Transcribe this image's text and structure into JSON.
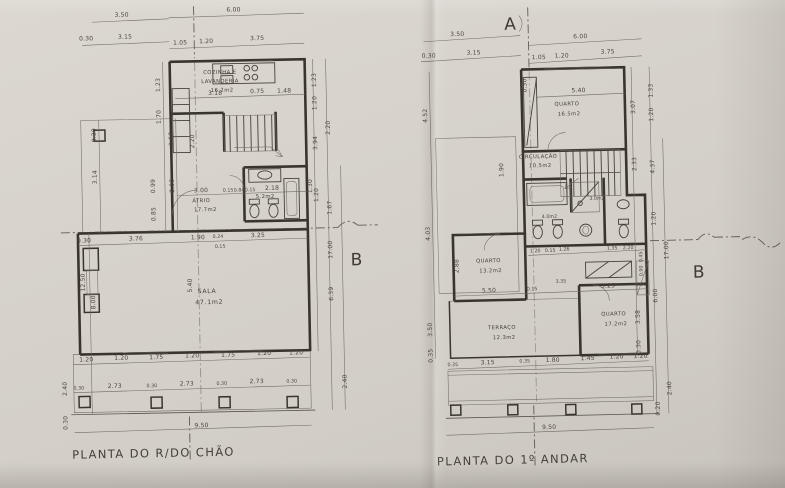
{
  "colors": {
    "paper": "#d6d2cb",
    "ink": "#4c463d",
    "wall": "#39352e"
  },
  "markers": {
    "a": "A",
    "b_left": "B",
    "b_right": "B"
  },
  "ground": {
    "caption": "PLANTA DO R/DO CHÃO",
    "rooms": {
      "kitchen_l1": "COZINHA E",
      "kitchen_l2": "LAVANDERIA",
      "kitchen_area": "16.2m2",
      "atrio": "ÁTRIO",
      "atrio_area": "17.7m2",
      "bath_area": "5.2m2",
      "sala": "SALA",
      "sala_area": "47.1m2"
    },
    "dims": [
      "3.50",
      "0.30",
      "3.15",
      "6.00",
      "1.05",
      "1.20",
      "3.75",
      "1.23",
      "1.70",
      "3.58",
      "8.00",
      "0.30",
      "3.14",
      "12.50",
      "8.00",
      "2.40",
      "0.30",
      "1.23",
      "1.20",
      "3.94",
      "1.20",
      "2.20",
      "1.67",
      "17.00",
      "6.39",
      "2.40",
      "3.18",
      "0.75",
      "1.48",
      "3.00",
      "0.15",
      "0.84",
      "0.15",
      "2.18",
      "1.30",
      "0.99",
      "0.85",
      "5.40",
      "2.20",
      "0.30",
      "3.76",
      "1.90",
      "0.24",
      "3.25",
      "0.15",
      "1.20",
      "1.20",
      "1.75",
      "1.20",
      "1.75",
      "1.20",
      "1.20",
      "0.30",
      "2.73",
      "0.30",
      "2.73",
      "0.30",
      "2.73",
      "0.30",
      "9.50"
    ]
  },
  "upper": {
    "caption": "PLANTA DO 1º ANDAR",
    "rooms": {
      "q1": "QUARTO",
      "q1_area": "16.5m2",
      "circ": "CIRCULAÇÃO",
      "circ_area": "10.5m2",
      "bath_area": "4.0m2",
      "shower_area": "3.0m2",
      "q2": "QUARTO",
      "q2_area": "13.2m2",
      "terr": "TERRAÇO",
      "terr_area": "12.3m2",
      "q3": "QUARTO",
      "q3_area": "17.2m2"
    },
    "dims": [
      "3.50",
      "0.30",
      "3.15",
      "6.00",
      "1.05",
      "1.20",
      "3.75",
      "5.40",
      "0.30",
      "4.52",
      "1.90",
      "4.03",
      "2.88",
      "3.50",
      "0.35",
      "1.33",
      "1.20",
      "3.07",
      "2.33",
      "4.37",
      "1.20",
      "17.00",
      "6.00",
      "3.58",
      "0.30",
      "2.40",
      "0.20",
      "1.20",
      "0.15",
      "1.26",
      "1.35",
      "2.20",
      "0.45",
      "0.90",
      "5.50",
      "0.15",
      "3.25",
      "0.30",
      "3.35",
      "0.35",
      "3.15",
      "0.35",
      "1.80",
      "1.45",
      "1.20",
      "1.20",
      "9.50"
    ]
  }
}
